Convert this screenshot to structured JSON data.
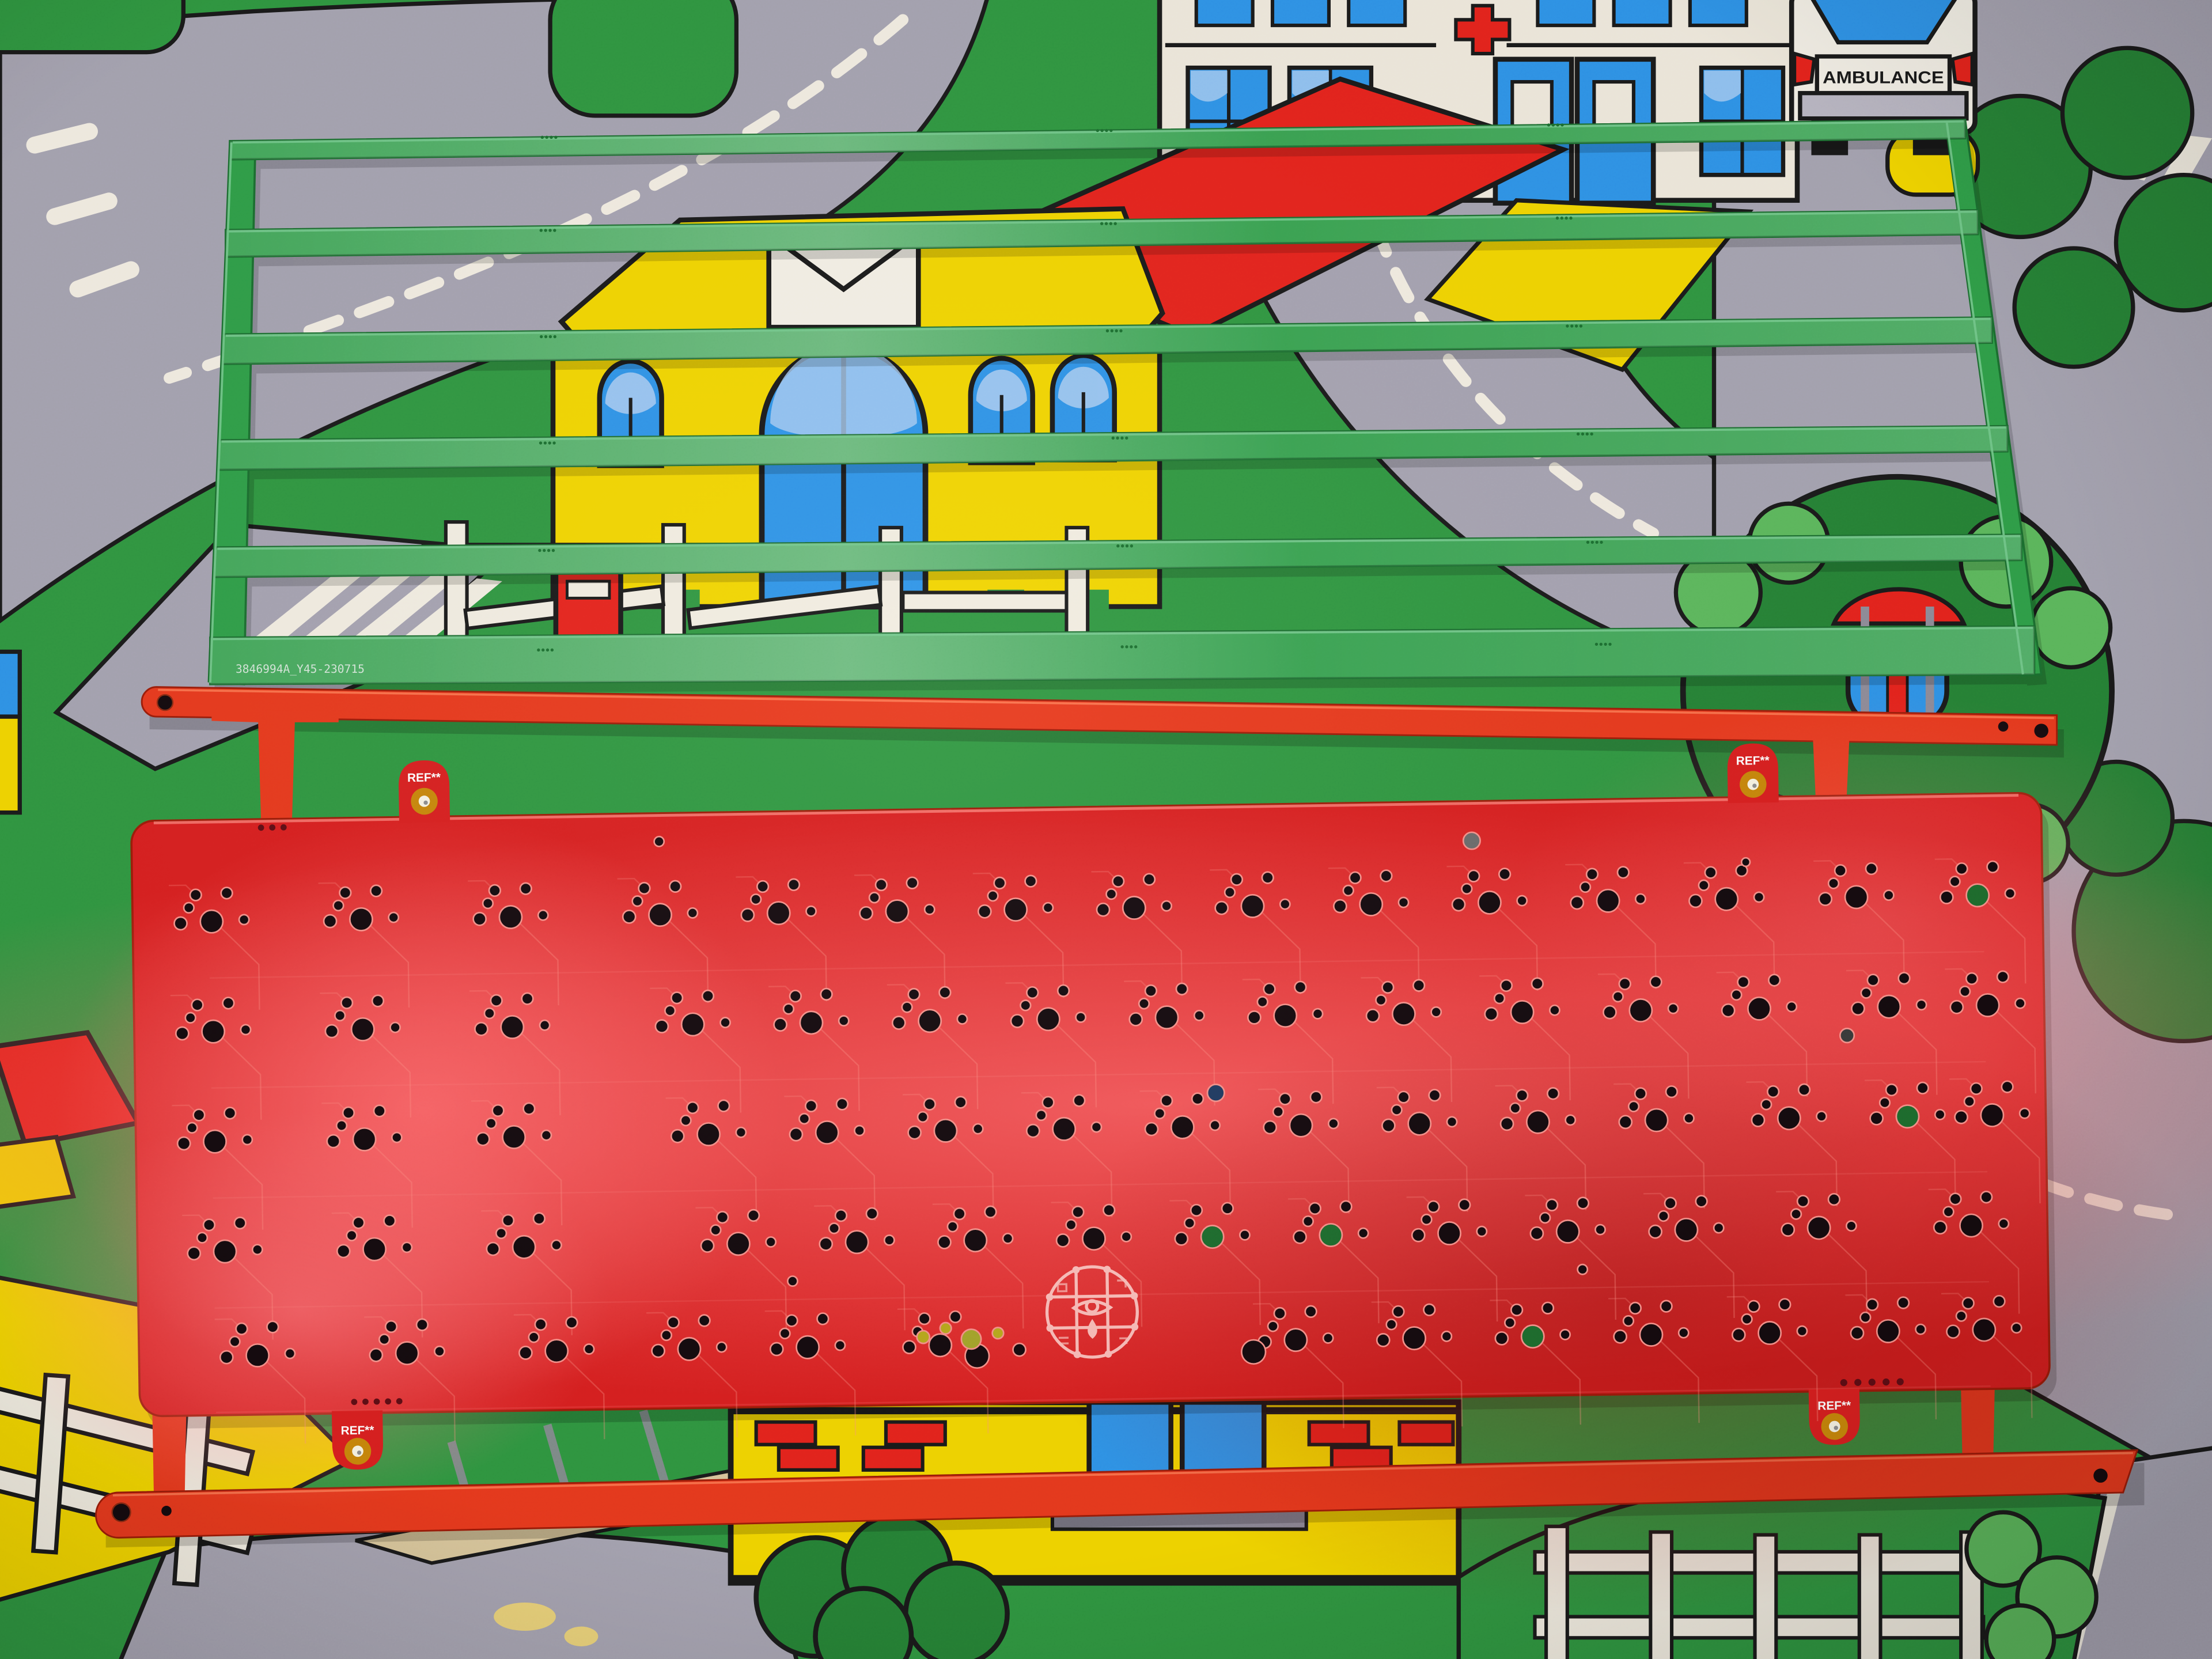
{
  "mat": {
    "ambulance_label": "AMBULANCE",
    "colors": {
      "grass": "#2f9640",
      "grass_dark": "#268235",
      "bush_light": "#5cb85c",
      "road": "#a5a2b0",
      "road_marking": "#f2ede1",
      "outline": "#1a1a1a",
      "house_yellow": "#f2d500",
      "roof_red": "#e6231c",
      "window_blue": "#2e93e8",
      "window_blue_light": "#a9cdf2",
      "building_cream": "#efe9dc",
      "cobble_tan": "#d9c69b",
      "bumper_gray": "#b9b6c2"
    }
  },
  "green_plate": {
    "serial_number": "3846994A_Y45-230715",
    "colors": {
      "body": "#2f9e48",
      "edge_dark": "#1b6e2f",
      "edge_light": "#74c98c"
    }
  },
  "red_pcb": {
    "ref_label": "REF**",
    "colors": {
      "rail": "#e8391d",
      "board": "#d81f1f",
      "board_pink": "#ff6d70",
      "board_pink2": "#ff8087",
      "board_shade": "#8e0f0f",
      "hole": "#140a0e",
      "hole_ring": "#f59089",
      "trace": "#ff9287",
      "gold_pad": "#c8860a",
      "gold_center": "#f7f3e2",
      "silkscreen": "#ffffff",
      "show_green": "#1e6b2d",
      "show_yellow": "#b7a81c"
    }
  }
}
